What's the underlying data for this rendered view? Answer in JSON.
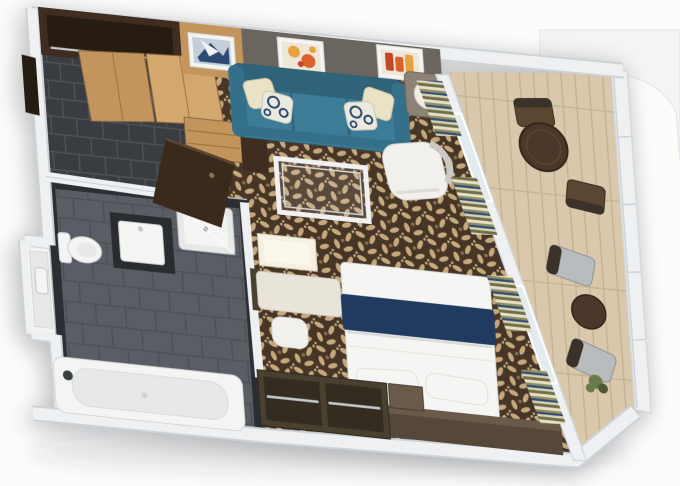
{
  "meta": {
    "description": "3D rendered top-down isometric floor plan of a cruise ship balcony suite stateroom",
    "view": "isometric floor plan, rotated clockwise"
  },
  "colors": {
    "background": "#fcfcfb",
    "wall": "#eef0f2",
    "wallEdge": "#cdd2d6",
    "grayWall": "#6b655f",
    "grayWallEdge": "#57524d",
    "woodLight": "#c3955c",
    "woodLightHi": "#d2a86e",
    "woodGrain": "#9c713f",
    "woodDark": "#3e2d20",
    "woodDarker": "#271c12",
    "carpetBase": "#473626",
    "carpetMotif": "#c5a87e",
    "carpetAccent": "#8a6d4b",
    "tileEntry": "#393c40",
    "tileEntryGrout": "#53565b",
    "tileBath": "#5a5e64",
    "tileBathGrout": "#4b4f55",
    "tileWallDark": "#2b2e32",
    "fixture": "#f4f5f3",
    "fixtureEdge": "#c9cdd0",
    "fixtureInner": "#e7e9e7",
    "counterDark": "#2a2d30",
    "sofa": "#3c7c96",
    "sofaDark": "#2e6379",
    "sofaMid": "#35708a",
    "pillowCream": "#eae2c4",
    "pillowWhite": "#eceae0",
    "pillowNavy": "#2c4a72",
    "lampBase": "#8d8276",
    "lampShade": "#efece2",
    "lampGlow": "#fdfcf4",
    "glassEdge": "#f0f1f2",
    "glassLine": "#d8dadc",
    "desk": "#e9e4d9",
    "deskEdge": "#d2ccc0",
    "mirror": "#f6f0e0",
    "mirrorEdge": "#d8cfba",
    "chairWhite": "#f1f0ec",
    "chairWhiteEdge": "#d9d7d1",
    "bedWhite": "#f5f5f3",
    "bedEdge": "#dcdcd7",
    "bedNavy": "#203a60",
    "console": "#55483a",
    "consoleTop": "#6a5a49",
    "wardrobeFrame": "#49402f",
    "wardrobeInner": "#332c21",
    "chrome": "#c4c8cc",
    "deckWood": "#d9c8ab",
    "deckPlank": "#c3b08f",
    "balconyTable": "#4b382a",
    "balconyChairWood": "#5b4632",
    "loungeSeat": "#b9bcbe",
    "loungeFrame": "#3a3128",
    "curtainCream": "#e8dfc4",
    "curtainOlive": "#8f8e63",
    "curtainNavy": "#2e4d74",
    "curtainCream2": "#d9d2b4",
    "curtainDark": "#6f6f4c",
    "door": "#3a2a1c",
    "doorEdge": "#5c452e",
    "glassDoor": "#e4ebee",
    "artFrame": "#f4f4f2",
    "artOrange": "#e8a23d",
    "artOrange2": "#d9622b",
    "artRed": "#c04a28",
    "artPaper": "#f0e6d8",
    "artBlueBg": "#c3cedb",
    "artBlueInk": "#2c4a72",
    "plant": "#6b7a4a",
    "plantDark": "#4c5a33"
  },
  "scene": {
    "rooms": [
      {
        "id": "entry",
        "items": [
          "entry-door",
          "closet-cabinet",
          "closet-doors",
          "chest-of-drawers"
        ]
      },
      {
        "id": "bathroom",
        "items": [
          "toilet",
          "shower-tray",
          "sink-vanity",
          "alcove-vanity",
          "bathtub",
          "swing-door"
        ]
      },
      {
        "id": "living-room",
        "items": [
          "sofa",
          "throw-pillows",
          "coffee-table",
          "armchair",
          "side-table",
          "lamp",
          "wall-art-blue",
          "wall-art-orange",
          "wall-art-red"
        ]
      },
      {
        "id": "dressing-area",
        "items": [
          "lighted-mirror",
          "vanity-desk",
          "stool"
        ]
      },
      {
        "id": "bedroom",
        "items": [
          "double-bed",
          "navy-bed-runner",
          "bed-pillows",
          "headboard-console",
          "open-wardrobe",
          "nightstand"
        ]
      },
      {
        "id": "window-wall",
        "items": [
          "glass-door-living",
          "glass-door-bedroom",
          "curtain-bundles-x4"
        ]
      },
      {
        "id": "balcony",
        "items": [
          "round-dining-table",
          "dining-chairs-x2",
          "lounge-chairs-x2",
          "side-table",
          "plant",
          "railing"
        ]
      }
    ]
  }
}
